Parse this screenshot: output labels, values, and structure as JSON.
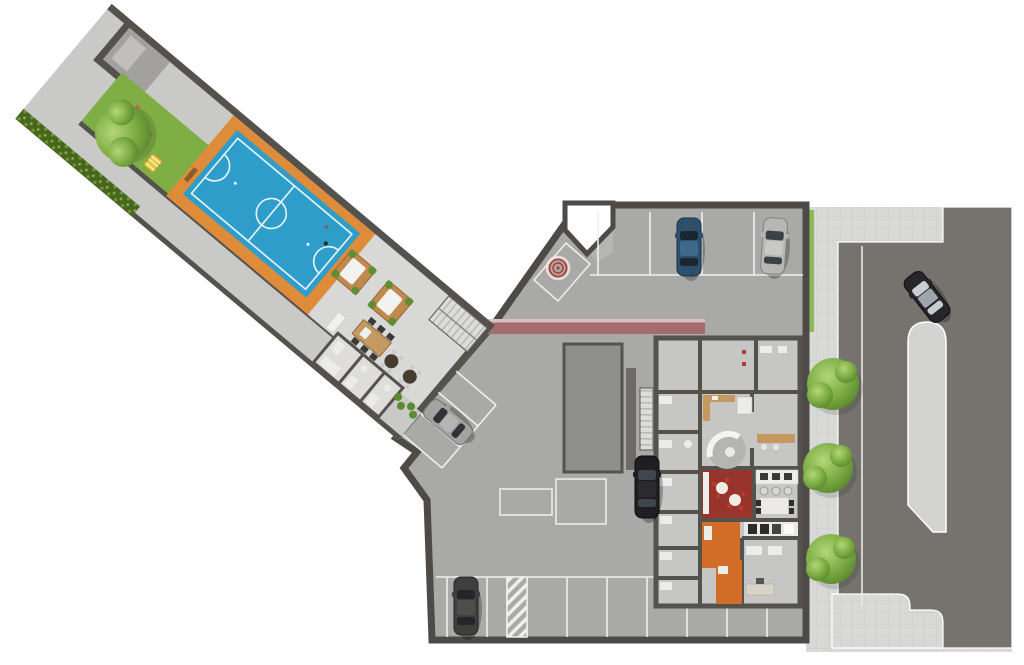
{
  "image": {
    "kind": "3d-rendered architectural floor plan / implantation plan",
    "view": "top-down",
    "background": "#ffffff"
  },
  "colors": {
    "court_blue": "#2f9dc9",
    "court_lines": "#eaf5f9",
    "court_apron": "#df8c3a",
    "lawn": "#7fae45",
    "hedge": "#49661f",
    "walkway": "#c9c9c7",
    "terrace": "#d8d8d6",
    "garage_floor": "#a9a9a7",
    "walls": "#55514d",
    "parking_lines": "#efefed",
    "red_stripe": "#a46c6e",
    "red_room": "#97352c",
    "orange_hall": "#d26e27",
    "wood": "#c59a62",
    "road": "#76736e",
    "sidewalk": "#d8d8d6",
    "median": "#d3d3d1",
    "spiral_red": "#b03a2e",
    "slab": "#8f8f8c",
    "stairs": "#dcdcda",
    "white_fixture": "#ececea"
  },
  "inventory": {
    "cars": [
      {
        "color": "dark blue",
        "location": "top parking row"
      },
      {
        "color": "silver",
        "location": "top parking row, right end"
      },
      {
        "color": "black with silver roof",
        "location": "street, driving"
      },
      {
        "color": "silver gray",
        "location": "diagonal spots at wing junction"
      },
      {
        "color": "black",
        "location": "central spot beside ramp slab"
      },
      {
        "color": "dark gray",
        "location": "bottom parking row"
      }
    ],
    "trees": {
      "street_strip": 3,
      "courtyard_wing": 1
    },
    "parking": {
      "top_row_spots": 4,
      "bottom_row_spots": 9,
      "diagonal_spots": 3,
      "no_parking_hatch_zones": 1,
      "floor_storage_outlines": 2
    },
    "amenities": [
      "futsal sports court",
      "playground lawn with playhouse",
      "pergola tables (2)",
      "party kitchen with dining table",
      "round patio tables (2)",
      "reception lounge with round rug and curved sofa",
      "red lounge room with bistro tables",
      "bar counter with 3 stools",
      "orange corridor",
      "staircases (2)",
      "hedge and perimeter landscaping",
      "street with median island and sidewalks"
    ],
    "markers": [
      "red spiral marker near garage entry",
      "red wall stripe demarcation"
    ]
  }
}
